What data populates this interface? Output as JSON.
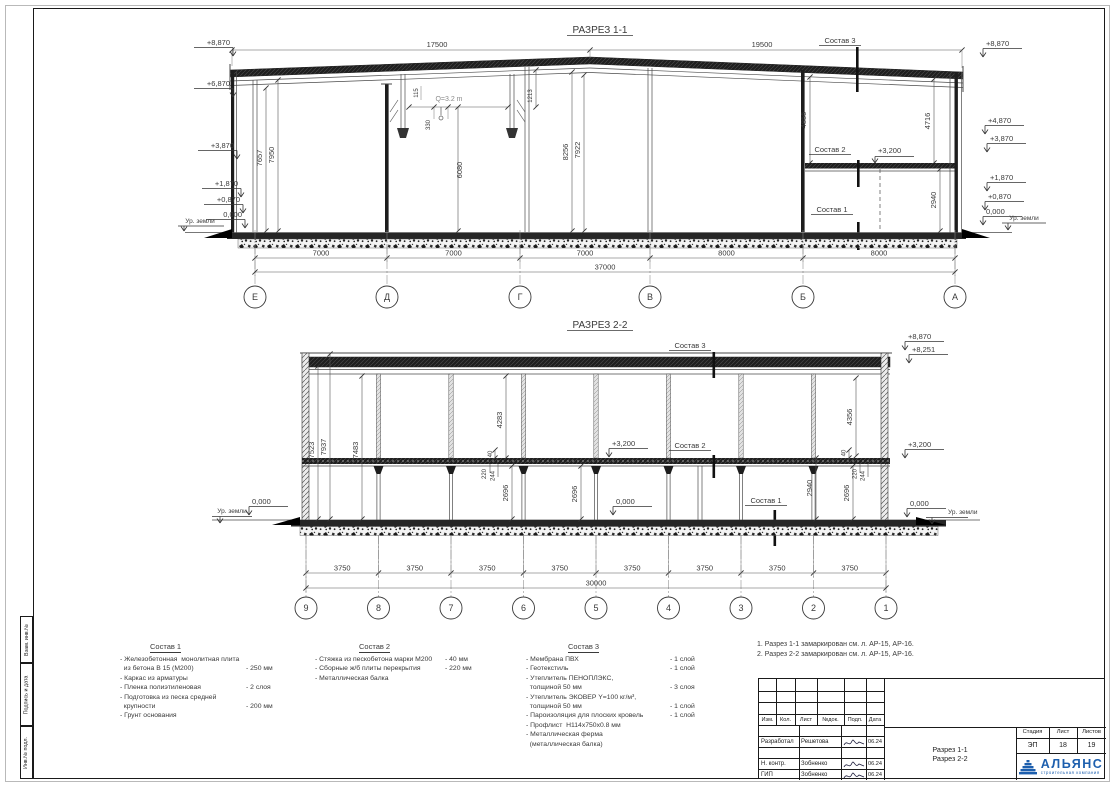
{
  "colors": {
    "logo_blue": "#1d5fae",
    "line_dark": "#1a1a1a",
    "dim_text": "#3a3a3a"
  },
  "side_stamps": [
    "Взам. инв.№",
    "Подпись и дата",
    "Инв.№ подл."
  ],
  "s1": {
    "title": "РАЗРЕЗ 1-1",
    "dim_17500": "17500",
    "dim_19500": "19500",
    "sostav3": "Состав 3",
    "sostav2": "Состав 2",
    "sostav1": "Состав 1",
    "level_3200": "+3,200",
    "crane": "Q=3.2 m",
    "elev_left": [
      "+8,870",
      "+6,870",
      "+3,870",
      "+1,870",
      "+0,870",
      "0,000"
    ],
    "elev_right": [
      "+8,870",
      "+4,870",
      "+3,870",
      "+1,870",
      "+0,870",
      "0,000"
    ],
    "ground_left": "Ур. земли",
    "ground_right": "Ур. земли",
    "vdims": {
      "v7657": "7657",
      "v7950": "7950",
      "v115": "115",
      "v330": "330",
      "v1213": "1213",
      "v6080": "6080",
      "v8256": "8256",
      "v7922": "7922",
      "v4855": "4855",
      "v4716": "4716",
      "v2940": "2940"
    },
    "bottom_dims": [
      "7000",
      "7000",
      "7000",
      "8000",
      "8000"
    ],
    "total": "37000",
    "axes": [
      "Е",
      "Д",
      "Г",
      "В",
      "Б",
      "А"
    ]
  },
  "s2": {
    "title": "РАЗРЕЗ 2-2",
    "sostav3": "Состав 3",
    "sostav2": "Состав 2",
    "sostav1": "Состав 1",
    "elev": {
      "e8870": "+8,870",
      "e8251": "+8,251",
      "e3200r": "+3,200",
      "e3200m": "+3,200",
      "zero_l": "0,000",
      "zero_m": "0,000",
      "zero_r": "0,000"
    },
    "ground_left": "Ур. земли",
    "ground_right": "Ур. земли",
    "vdims": {
      "v7523": "7523",
      "v7937": "7937",
      "v7483": "7483",
      "v4283": "4283",
      "v4356": "4356",
      "v40a": "40",
      "v40b": "40",
      "v220a": "220",
      "v244a": "244",
      "v220b": "220",
      "v244b": "244",
      "v2696a": "2696",
      "v2696b": "2696",
      "v2696c": "2696",
      "v2940": "2940"
    },
    "bottom_dims": [
      "3750",
      "3750",
      "3750",
      "3750",
      "3750",
      "3750",
      "3750",
      "3750"
    ],
    "total": "30000",
    "axes": [
      "9",
      "8",
      "7",
      "6",
      "5",
      "4",
      "3",
      "2",
      "1"
    ]
  },
  "legend": {
    "groups": [
      {
        "title": "Состав 1",
        "items": [
          {
            "t": "- Железобетонная  монолитная плита",
            "v": ""
          },
          {
            "t": "  из бетона В 15 (М200)",
            "v": "- 250 мм"
          },
          {
            "t": "- Каркас из арматуры",
            "v": ""
          },
          {
            "t": "- Пленка полиэтиленовая",
            "v": "- 2 слоя"
          },
          {
            "t": "- Подготовка из песка средней",
            "v": ""
          },
          {
            "t": "  крупности",
            "v": "- 200 мм"
          },
          {
            "t": "- Грунт основания",
            "v": ""
          }
        ]
      },
      {
        "title": "Состав 2",
        "items": [
          {
            "t": "- Стяжка из пескобетона марки М200",
            "v": "- 40 мм"
          },
          {
            "t": "- Сборные ж/б плиты перекрытия",
            "v": "- 220 мм"
          },
          {
            "t": "- Металлическая балка",
            "v": ""
          }
        ]
      },
      {
        "title": "Состав 3",
        "items": [
          {
            "t": "- Мембрана ПВХ",
            "v": "- 1 слой"
          },
          {
            "t": "- Геотекстиль",
            "v": "- 1 слой"
          },
          {
            "t": "- Утеплитель ПЕНОПЛЭКС,",
            "v": ""
          },
          {
            "t": "  толщиной 50 мм",
            "v": "- 3 слоя"
          },
          {
            "t": "- Утеплитель ЭКОВЕР Y=100 кг/м³,",
            "v": ""
          },
          {
            "t": "  толщиной 50 мм",
            "v": "- 1 слой"
          },
          {
            "t": "- Пароизоляция для плоских кровель",
            "v": "- 1 слой"
          },
          {
            "t": "- Профлист  Н114х750х0.8 мм",
            "v": ""
          },
          {
            "t": "- Металлическая ферма",
            "v": ""
          },
          {
            "t": "  (металлическая балка)",
            "v": ""
          }
        ]
      }
    ]
  },
  "notes": [
    "1. Разрез 1-1 замаркирован см. л. АР-15, АР-16.",
    "2. Разрез 2-2 замаркирован см. л. АР-15, АР-16."
  ],
  "titleblock": {
    "headers": [
      "Изм.",
      "Кол.",
      "Лист",
      "№док.",
      "Подп.",
      "Дата"
    ],
    "rows": [
      {
        "role": "",
        "name": "",
        "date": "",
        "sig": false
      },
      {
        "role": "Разработал",
        "name": "Решетова",
        "date": "06.24",
        "sig": true
      },
      {
        "role": "",
        "name": "",
        "date": "",
        "sig": false
      },
      {
        "role": "Н. контр.",
        "name": "Зобненко",
        "date": "06.24",
        "sig": true
      },
      {
        "role": "ГИП",
        "name": "Зобненко",
        "date": "06.24",
        "sig": true
      }
    ],
    "doc_title_line1": "Разрез 1-1",
    "doc_title_line2": "Разрез 2-2",
    "stage_label": "Стадия",
    "sheet_label": "Лист",
    "sheets_label": "Листов",
    "stage": "ЭП",
    "sheet": "18",
    "sheets": "19",
    "logo": {
      "name": "АЛЬЯНС",
      "subtitle": "строительная компания"
    }
  }
}
